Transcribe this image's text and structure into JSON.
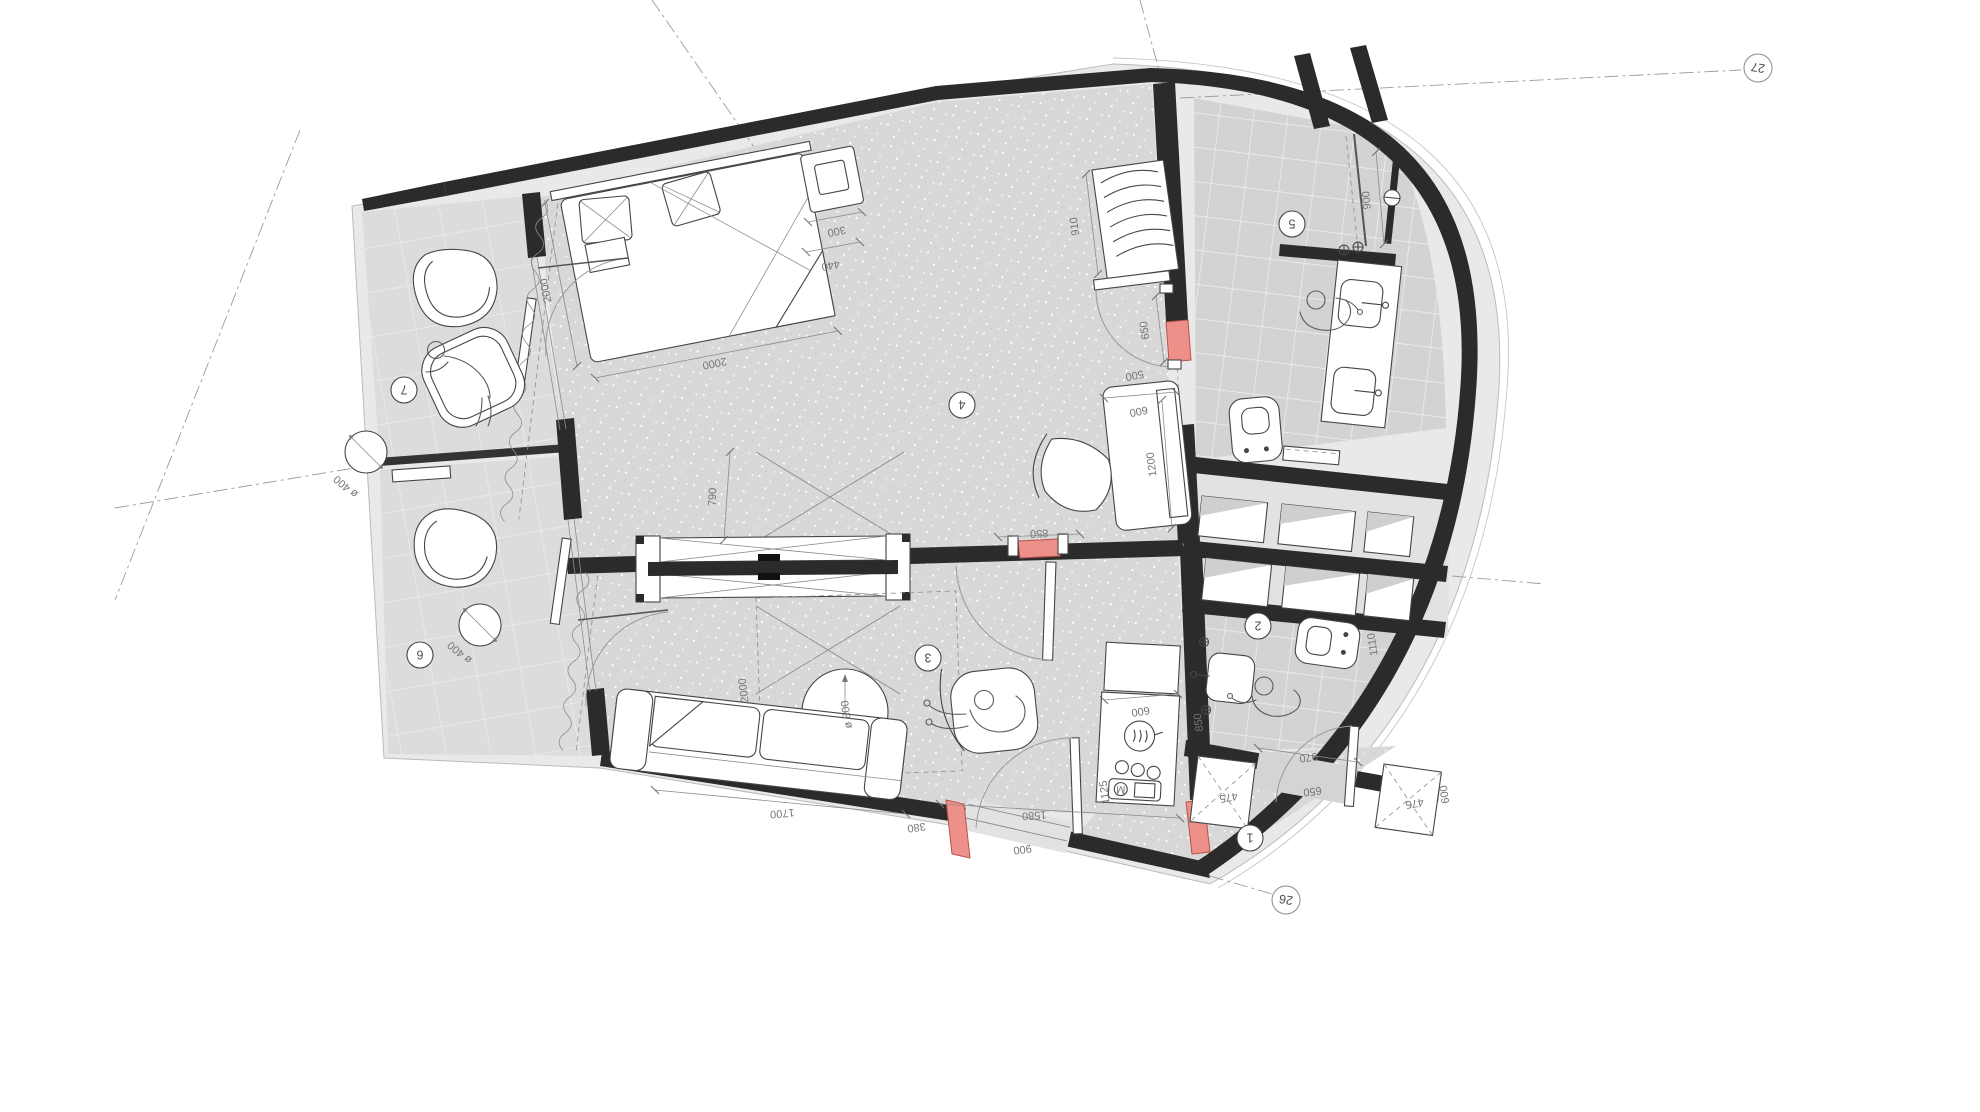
{
  "drawing": {
    "room_tags": {
      "corridor": "1",
      "bath_lower": "2",
      "living": "3",
      "bedroom": "4",
      "bath_upper": "5",
      "balcony_lower": "6",
      "balcony_upper": "7"
    },
    "grid_tags": {
      "top_right": "27",
      "bottom_right": "26"
    },
    "colors": {
      "wall": "#2b2b2b",
      "floor_speckle": "#d8d8d8",
      "tile": "#d3d3d3",
      "balcony_tile": "#dcdcdc",
      "slab": "#e9e9e9",
      "highlight_red": "#ec9089"
    },
    "dims": {
      "bedroom": {
        "bed_side": "2000",
        "bed_foot": "2000",
        "nightstand_top": "300",
        "nightstand_side": "440",
        "wardrobe": "910",
        "joinery": "790",
        "bath_door_opening": "650",
        "bath_door_infill": "500",
        "party_door": "850",
        "desk_depth": "600",
        "desk_length": "1200"
      },
      "bath_upper": {
        "shower": "900"
      },
      "living": {
        "table_diameter": "ø 800",
        "seating_zone": "2000",
        "sofa": "1700",
        "kitchen_counter": "600",
        "kitchen_run": "1580",
        "entry_segment": "380",
        "entry_opening": "900"
      },
      "bath_lower": {
        "fixture": "1110",
        "door_clear": "970",
        "door_leaf": "650"
      },
      "corridor": {
        "niche_left": "475",
        "niche_right": "475",
        "niche_depth": "600",
        "entry_width": "1125",
        "side_clear": "850"
      },
      "balcony_upper": {
        "table": "ø 400"
      },
      "balcony_lower": {
        "table": "ø 400"
      }
    },
    "logo": "M"
  }
}
